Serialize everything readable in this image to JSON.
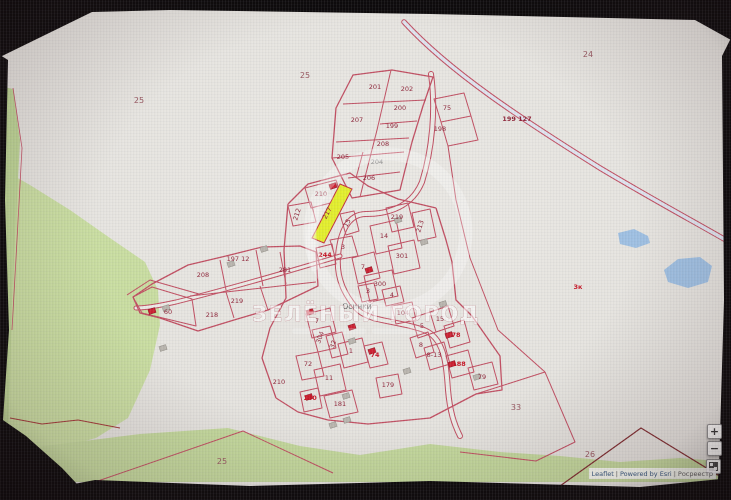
{
  "map": {
    "watermark": "ЗЕЛЁНЫЙ ГОРОД",
    "selected_parcel": "217",
    "selected_parcel_color": "#e3ee2e",
    "parcel_line_color": "#c14f62",
    "labels": [
      {
        "t": "25",
        "x": 139,
        "y": 103,
        "c": "out"
      },
      {
        "t": "25",
        "x": 305,
        "y": 78,
        "c": "out"
      },
      {
        "t": "24",
        "x": 588,
        "y": 57,
        "c": "out"
      },
      {
        "t": "33",
        "x": 516,
        "y": 410,
        "c": "out"
      },
      {
        "t": "26",
        "x": 590,
        "y": 457,
        "c": "out"
      },
      {
        "t": "25",
        "x": 222,
        "y": 464,
        "c": "out"
      },
      {
        "t": "199 127",
        "x": 517,
        "y": 121,
        "c": "road"
      },
      {
        "t": "3к",
        "x": 578,
        "y": 289,
        "c": "red"
      },
      {
        "t": "201",
        "x": 375,
        "y": 89
      },
      {
        "t": "202",
        "x": 407,
        "y": 91
      },
      {
        "t": "200",
        "x": 400,
        "y": 110
      },
      {
        "t": "207",
        "x": 357,
        "y": 122
      },
      {
        "t": "199",
        "x": 392,
        "y": 128
      },
      {
        "t": "75",
        "x": 447,
        "y": 110
      },
      {
        "t": "198",
        "x": 440,
        "y": 131
      },
      {
        "t": "208",
        "x": 383,
        "y": 146
      },
      {
        "t": "205",
        "x": 343,
        "y": 159
      },
      {
        "t": "204",
        "x": 377,
        "y": 164,
        "c": "gray"
      },
      {
        "t": "206",
        "x": 369,
        "y": 180
      },
      {
        "t": "197 12",
        "x": 238,
        "y": 261
      },
      {
        "t": "208",
        "x": 203,
        "y": 277
      },
      {
        "t": "281",
        "x": 285,
        "y": 272
      },
      {
        "t": "219",
        "x": 237,
        "y": 303
      },
      {
        "t": "218",
        "x": 212,
        "y": 317
      },
      {
        "t": "60",
        "x": 168,
        "y": 314
      },
      {
        "t": "210",
        "x": 279,
        "y": 384
      },
      {
        "t": "210",
        "x": 321,
        "y": 196
      },
      {
        "t": "212",
        "x": 299,
        "y": 215,
        "r": -72
      },
      {
        "t": "217",
        "x": 329,
        "y": 214,
        "r": -62
      },
      {
        "t": "15",
        "x": 349,
        "y": 224,
        "r": -62
      },
      {
        "t": "219",
        "x": 397,
        "y": 219
      },
      {
        "t": "213",
        "x": 422,
        "y": 227,
        "r": -72
      },
      {
        "t": "3",
        "x": 343,
        "y": 249
      },
      {
        "t": "244",
        "x": 325,
        "y": 257,
        "c": "red"
      },
      {
        "t": "14",
        "x": 384,
        "y": 238
      },
      {
        "t": "301",
        "x": 402,
        "y": 258
      },
      {
        "t": "7",
        "x": 363,
        "y": 269
      },
      {
        "t": "300",
        "x": 380,
        "y": 286
      },
      {
        "t": "3",
        "x": 368,
        "y": 293
      },
      {
        "t": "4",
        "x": 392,
        "y": 297
      },
      {
        "t": "104",
        "x": 403,
        "y": 315
      },
      {
        "t": "7",
        "x": 317,
        "y": 323
      },
      {
        "t": "304",
        "x": 322,
        "y": 338,
        "r": -70
      },
      {
        "t": "32",
        "x": 335,
        "y": 345,
        "r": -70
      },
      {
        "t": "1",
        "x": 351,
        "y": 353
      },
      {
        "t": "72",
        "x": 308,
        "y": 366
      },
      {
        "t": "11",
        "x": 329,
        "y": 380
      },
      {
        "t": "74",
        "x": 375,
        "y": 357,
        "c": "red"
      },
      {
        "t": "179",
        "x": 388,
        "y": 387
      },
      {
        "t": "180",
        "x": 310,
        "y": 400,
        "c": "red"
      },
      {
        "t": "181",
        "x": 340,
        "y": 406
      },
      {
        "t": "15",
        "x": 440,
        "y": 321
      },
      {
        "t": "5",
        "x": 422,
        "y": 328
      },
      {
        "t": "8",
        "x": 421,
        "y": 347
      },
      {
        "t": "8-13",
        "x": 434,
        "y": 357
      },
      {
        "t": "78",
        "x": 456,
        "y": 337,
        "c": "red"
      },
      {
        "t": "188",
        "x": 459,
        "y": 366,
        "c": "red"
      },
      {
        "t": "79",
        "x": 482,
        "y": 379
      },
      {
        "t": "Осинки",
        "x": 357,
        "y": 309,
        "c": "place"
      }
    ],
    "buildings_red": [
      [
        333,
        186
      ],
      [
        369,
        270
      ],
      [
        310,
        312
      ],
      [
        152,
        311
      ],
      [
        352,
        327
      ],
      [
        372,
        351
      ],
      [
        309,
        397
      ],
      [
        449,
        335
      ],
      [
        452,
        364
      ]
    ],
    "buildings_gray": [
      [
        398,
        220
      ],
      [
        424,
        242
      ],
      [
        443,
        304
      ],
      [
        352,
        341
      ],
      [
        407,
        371
      ],
      [
        477,
        377
      ],
      [
        346,
        396
      ],
      [
        347,
        420
      ],
      [
        333,
        425
      ],
      [
        264,
        249
      ],
      [
        231,
        264
      ],
      [
        163,
        348
      ],
      [
        166,
        308
      ]
    ]
  },
  "controls": {
    "zoom_in": "+",
    "zoom_out": "−"
  },
  "attribution": {
    "leaflet": "Leaflet",
    "separator": "|",
    "powered": "Powered by Esri",
    "registry": "Росреестр"
  }
}
